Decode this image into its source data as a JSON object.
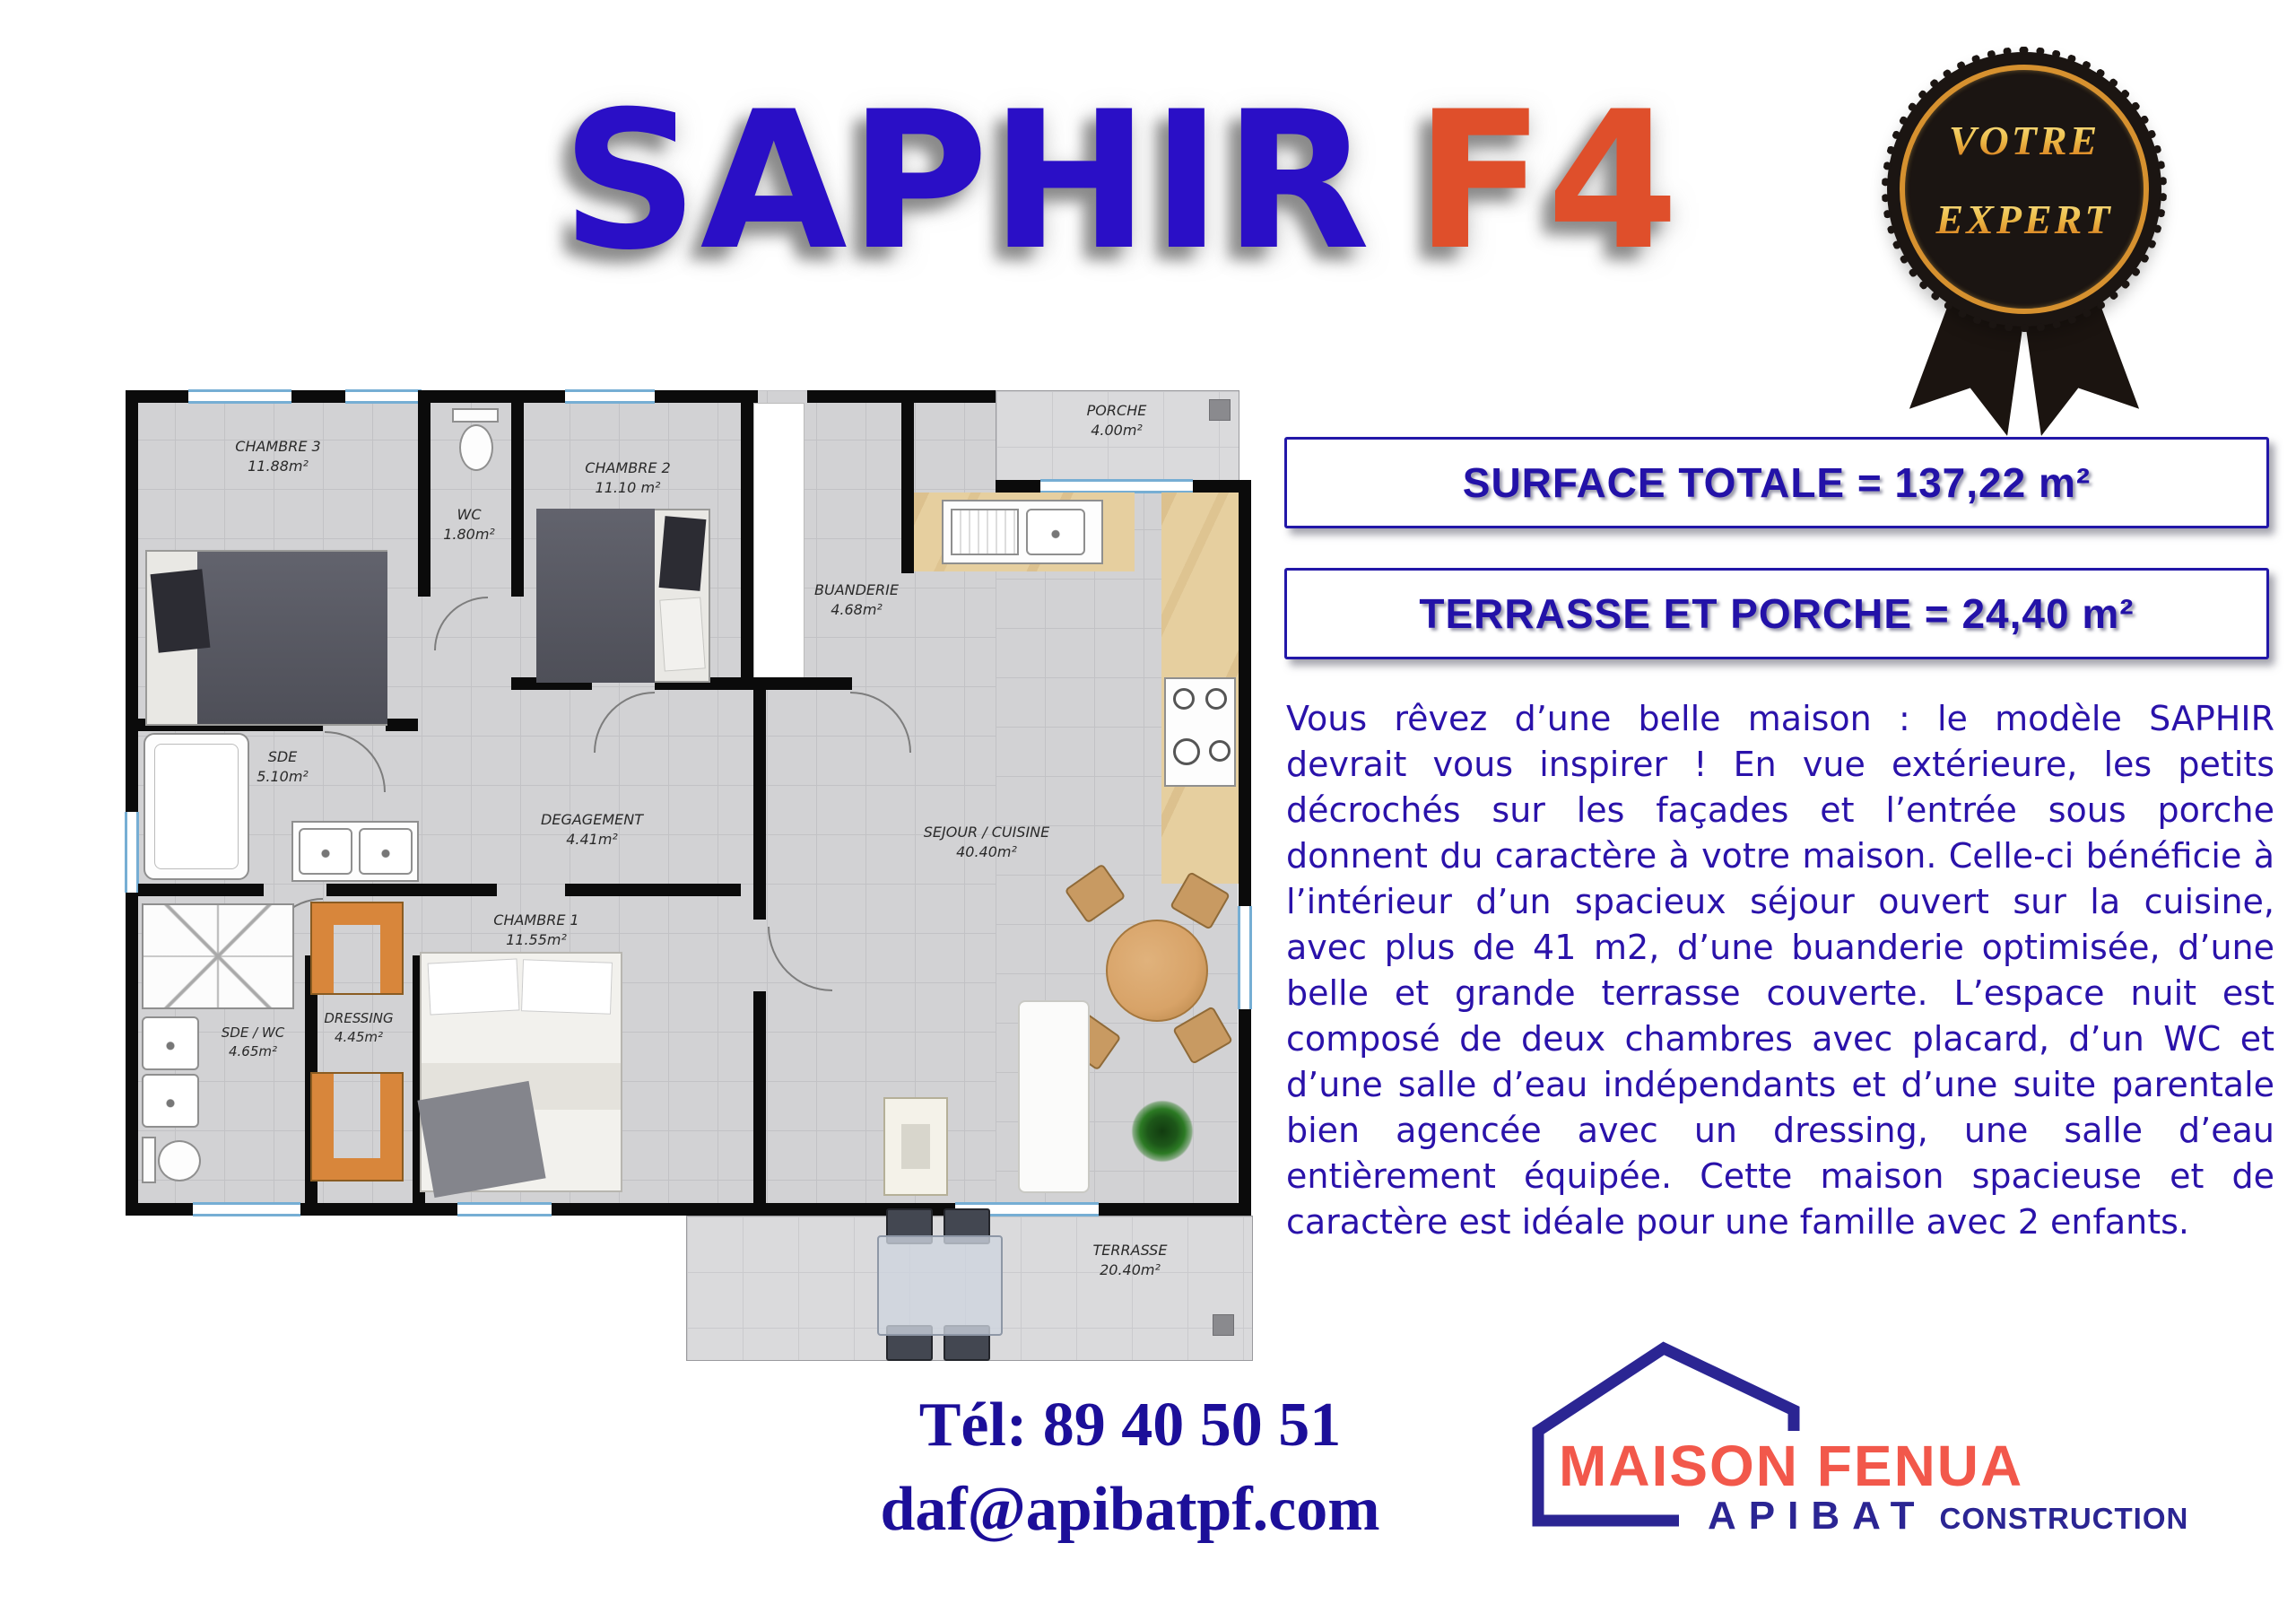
{
  "title": {
    "main": "SAPHIR",
    "suffix": "F4"
  },
  "badge": {
    "line1": "VOTRE",
    "line2": "EXPERT"
  },
  "banners": [
    {
      "text": "SURFACE TOTALE = 137,22 m²"
    },
    {
      "text": "TERRASSE ET PORCHE = 24,40 m²"
    }
  ],
  "description": "Vous rêvez d’une belle maison : le modèle SAPHIR devrait vous inspirer ! En vue extérieure, les petits décrochés sur les façades et l’entrée sous porche donnent du caractère à votre maison. Celle-ci bénéficie à l’intérieur d’un spacieux séjour ouvert sur la cuisine, avec plus de 41 m2, d’une buanderie optimisée, d’une belle et grande terrasse couverte. L’espace nuit est composé de deux chambres avec placard, d’un WC et d’une salle d’eau indépendants et d’une suite parentale bien agencée avec un dressing, une salle d’eau entièrement équipée. Cette maison spacieuse et de caractère est idéale pour une famille avec 2 enfants.",
  "contact": {
    "phone": "Tél: 89 40 50 51",
    "email": "daf@apibatpf.com"
  },
  "logo": {
    "brand": "MAISON FENUA",
    "sub": "APIBAT",
    "sub2": "CONSTRUCTION"
  },
  "floorplan": {
    "rooms": [
      {
        "name": "CHAMBRE 3",
        "area": "11.88m²"
      },
      {
        "name": "WC",
        "area": "1.80m²"
      },
      {
        "name": "CHAMBRE 2",
        "area": "11.10 m²"
      },
      {
        "name": "BUANDERIE",
        "area": "4.68m²"
      },
      {
        "name": "PORCHE",
        "area": "4.00m²"
      },
      {
        "name": "SDE",
        "area": "5.10m²"
      },
      {
        "name": "DEGAGEMENT",
        "area": "4.41m²"
      },
      {
        "name": "SEJOUR / CUISINE",
        "area": "40.40m²"
      },
      {
        "name": "CHAMBRE 1",
        "area": "11.55m²"
      },
      {
        "name": "DRESSING",
        "area": "4.45m²"
      },
      {
        "name": "SDE / WC",
        "area": "4.65m²"
      },
      {
        "name": "TERRASSE",
        "area": "20.40m²"
      }
    ]
  },
  "colors": {
    "title_blue": "#2a0fc6",
    "title_orange": "#df4f2b",
    "banner_blue": "#2312a8",
    "text_blue": "#2a12aa",
    "logo_red": "#f2584b",
    "logo_blue": "#2b2593",
    "badge_gold": "#edb43d",
    "wall_black": "#0b0b0b",
    "floor_gray": "#d2d2d4",
    "wood_orange": "#d8863b"
  }
}
